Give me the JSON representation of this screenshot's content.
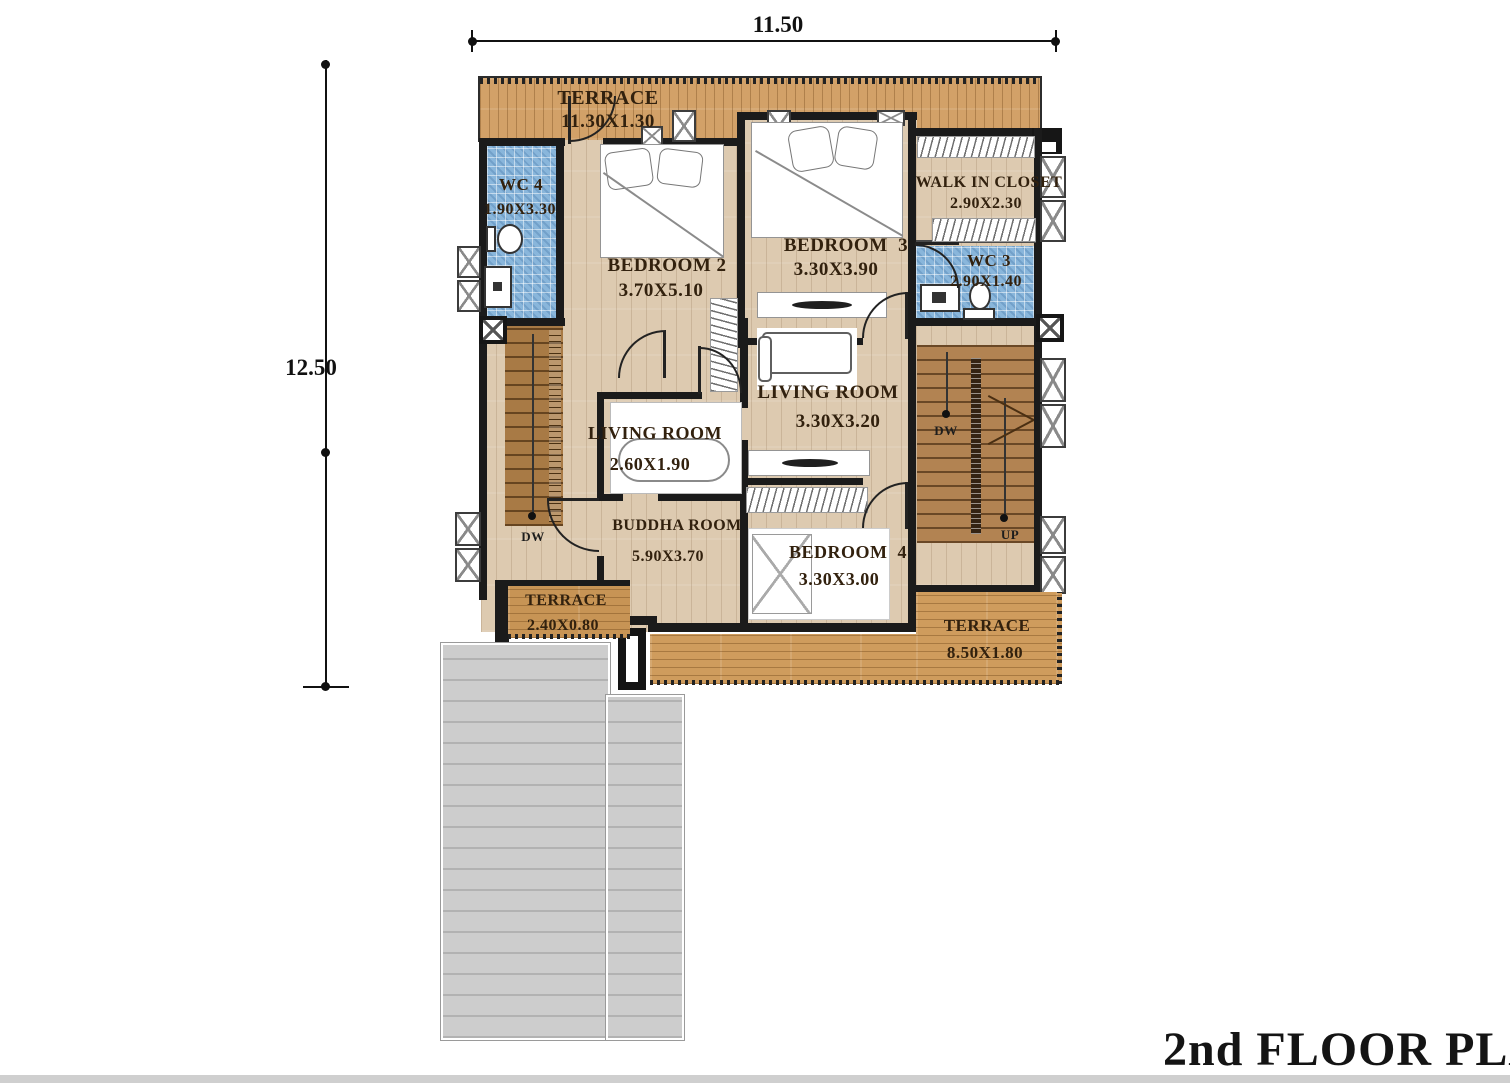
{
  "title": "2nd FLOOR PLAN",
  "dimensions": {
    "top": "11.50",
    "left": "12.50"
  },
  "rooms": {
    "terrace_top": {
      "name": "TERRACE",
      "size": "11.30X1.30"
    },
    "wc4": {
      "name": "WC 4",
      "size": "1.90X3.30"
    },
    "bedroom2": {
      "name": "BEDROOM 2",
      "size": "3.70X5.10"
    },
    "bedroom3": {
      "name": "BEDROOM  3",
      "size": "3.30X3.90"
    },
    "walk_in_closet": {
      "name": "WALK IN CLOSET",
      "size": "2.90X2.30"
    },
    "wc3": {
      "name": "WC 3",
      "size": "2.90X1.40"
    },
    "living_room_right": {
      "name": "LIVING ROOM",
      "size": "3.30X3.20"
    },
    "living_room_left": {
      "name": "LIVING ROOM",
      "size": "2.60X1.90"
    },
    "buddha_room": {
      "name": "BUDDHA ROOM",
      "size": "5.90X3.70"
    },
    "bedroom4": {
      "name": "BEDROOM  4",
      "size": "3.30X3.00"
    },
    "terrace_bottom_left": {
      "name": "TERRACE",
      "size": "2.40X0.80"
    },
    "terrace_bottom_right": {
      "name": "TERRACE",
      "size": "8.50X1.80"
    }
  },
  "stairs": {
    "left": {
      "down": "DW"
    },
    "right": {
      "down": "DW",
      "up": "UP"
    }
  },
  "colors": {
    "wall": "#1b1b1b",
    "deck_wood": "#d2a168",
    "floor_wood": "#ddcab0",
    "tile_blue": "#89b6db",
    "stair_wood": "#a87a45",
    "roof_gray": "#cdcdcd"
  }
}
